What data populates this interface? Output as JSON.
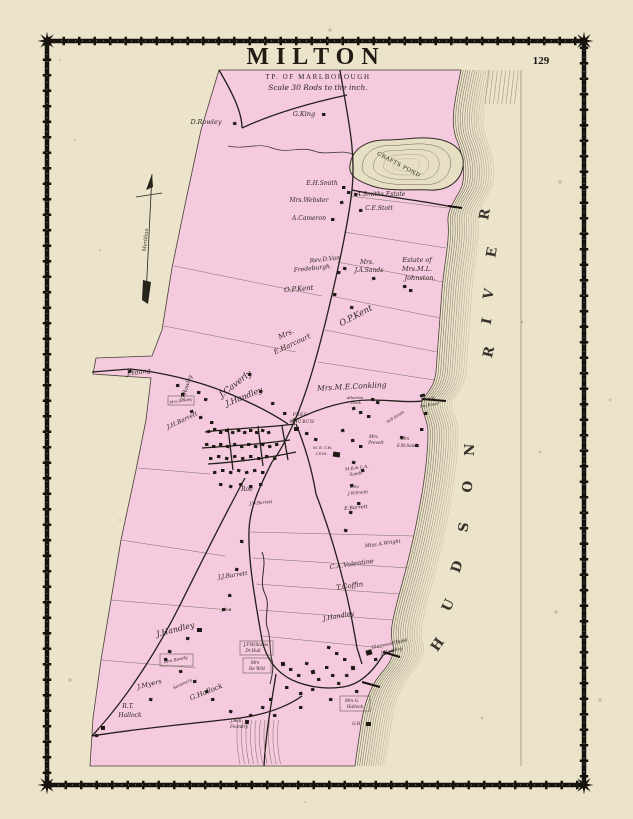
{
  "page": {
    "number": "129"
  },
  "title": {
    "main": "MILTON",
    "township": "TP. OF MARLBOROUGH",
    "scale_note": "Scale 30 Rods to the inch."
  },
  "map": {
    "labels": [
      {
        "t": "D.Rowley",
        "x": 206,
        "y": 124,
        "s": 6.5,
        "r": 0
      },
      {
        "t": "G.King",
        "x": 304,
        "y": 116,
        "s": 6.5,
        "r": 0
      },
      {
        "t": "CRAFTS POND",
        "x": 398,
        "y": 166,
        "s": 5.5,
        "r": 28,
        "c": "c",
        "ls": 1.5
      },
      {
        "t": "E.H.Smith",
        "x": 322,
        "y": 185,
        "s": 6,
        "r": 0
      },
      {
        "t": "A.Smiths Estate",
        "x": 381,
        "y": 196,
        "s": 6,
        "r": 0
      },
      {
        "t": "Mrs.Webster",
        "x": 309,
        "y": 202,
        "s": 6,
        "r": 0
      },
      {
        "t": "C.E.Stott",
        "x": 379,
        "y": 210,
        "s": 6,
        "r": 0
      },
      {
        "t": "A.Cameron",
        "x": 309,
        "y": 220,
        "s": 6,
        "r": 0
      },
      {
        "t": "Rev.D.Van",
        "x": 325,
        "y": 261,
        "s": 6,
        "r": -6
      },
      {
        "t": "Fredeburgh.",
        "x": 313,
        "y": 270,
        "s": 6,
        "r": -6
      },
      {
        "t": "Mrs.",
        "x": 367,
        "y": 264,
        "s": 6,
        "r": 0
      },
      {
        "t": "J.A.Sands",
        "x": 369,
        "y": 272,
        "s": 6,
        "r": 0
      },
      {
        "t": "Estate of",
        "x": 417,
        "y": 262,
        "s": 6.5,
        "r": 0
      },
      {
        "t": "Mrs.M.L.",
        "x": 417,
        "y": 271,
        "s": 6.5,
        "r": 0
      },
      {
        "t": "Johnston.",
        "x": 420,
        "y": 280,
        "s": 6.5,
        "r": 0
      },
      {
        "t": "O.P.Kent",
        "x": 299,
        "y": 291,
        "s": 7,
        "r": -5
      },
      {
        "t": "O.P.Kent",
        "x": 357,
        "y": 318,
        "s": 8.5,
        "r": -28
      },
      {
        "t": "Mrs.",
        "x": 287,
        "y": 336,
        "s": 7,
        "r": -25
      },
      {
        "t": "E.Harcourt",
        "x": 293,
        "y": 346,
        "s": 7,
        "r": -25
      },
      {
        "t": "J.Young",
        "x": 139,
        "y": 374,
        "s": 6.5,
        "r": -8
      },
      {
        "t": "D.Rowley",
        "x": 188,
        "y": 388,
        "s": 5.5,
        "r": -72
      },
      {
        "t": "Mrs.Rowley",
        "x": 181,
        "y": 402,
        "s": 3.8,
        "r": -8
      },
      {
        "t": "J.Caverly",
        "x": 237,
        "y": 386,
        "s": 8.5,
        "r": -38
      },
      {
        "t": "J.Handley",
        "x": 245,
        "y": 399,
        "s": 8,
        "r": -22
      },
      {
        "t": "Mrs.M.E.Conkling",
        "x": 352,
        "y": 389,
        "s": 7.5,
        "r": -3
      },
      {
        "t": "J.H.Barrett",
        "x": 183,
        "y": 422,
        "s": 6,
        "r": -25
      },
      {
        "t": "PRES.",
        "x": 301,
        "y": 416,
        "s": 4.5,
        "r": 0,
        "c": "c"
      },
      {
        "t": "CHURCH",
        "x": 302,
        "y": 423,
        "s": 4.5,
        "r": 0,
        "c": "c"
      },
      {
        "t": "Atherton",
        "x": 355,
        "y": 399,
        "s": 3.8,
        "r": 0
      },
      {
        "t": "Dock",
        "x": 356,
        "y": 404,
        "s": 3.8,
        "r": 0
      },
      {
        "t": "J.Sands",
        "x": 428,
        "y": 400,
        "s": 3.8,
        "r": -10
      },
      {
        "t": "Sto.House",
        "x": 430,
        "y": 406,
        "s": 3.8,
        "r": -10
      },
      {
        "t": "W.B.Sands",
        "x": 396,
        "y": 418,
        "s": 3.8,
        "r": -32
      },
      {
        "t": "Mrs.",
        "x": 374,
        "y": 438,
        "s": 4.2,
        "r": 0
      },
      {
        "t": "Prevett",
        "x": 376,
        "y": 444,
        "s": 4.2,
        "r": 0
      },
      {
        "t": "Mrs",
        "x": 405,
        "y": 440,
        "s": 4.2,
        "r": 0
      },
      {
        "t": "S.M.Sands",
        "x": 408,
        "y": 447,
        "s": 4.2,
        "r": 0
      },
      {
        "t": "M.E.CH.",
        "x": 323,
        "y": 449,
        "s": 3.8,
        "r": 0,
        "c": "c"
      },
      {
        "t": "CEM.",
        "x": 322,
        "y": 455,
        "s": 3.8,
        "r": 0,
        "c": "c"
      },
      {
        "t": "M.B.& L.A.",
        "x": 357,
        "y": 469,
        "s": 4.2,
        "r": -8
      },
      {
        "t": "Sands",
        "x": 356,
        "y": 475,
        "s": 4.2,
        "r": -8
      },
      {
        "t": "Rev.",
        "x": 355,
        "y": 488,
        "s": 4.2,
        "r": 0
      },
      {
        "t": "J.W.Smith",
        "x": 358,
        "y": 494,
        "s": 4.2,
        "r": -5
      },
      {
        "t": "E.Barrett",
        "x": 356,
        "y": 509,
        "s": 5,
        "r": -5
      },
      {
        "t": "Roe",
        "x": 247,
        "y": 491,
        "s": 6,
        "r": 0
      },
      {
        "t": "J.W.Barrett",
        "x": 261,
        "y": 504,
        "s": 4.2,
        "r": -5
      },
      {
        "t": "Miss A.Wright",
        "x": 383,
        "y": 545,
        "s": 5,
        "r": -8
      },
      {
        "t": "C.A.Valentine",
        "x": 352,
        "y": 566,
        "s": 6.5,
        "r": -8
      },
      {
        "t": "T.Coffin",
        "x": 350,
        "y": 588,
        "s": 7,
        "r": -8
      },
      {
        "t": "J.Handley",
        "x": 339,
        "y": 618,
        "s": 6.5,
        "r": -10
      },
      {
        "t": "J.J.Barrett",
        "x": 233,
        "y": 577,
        "s": 6,
        "r": -8
      },
      {
        "t": "J.C.B.",
        "x": 227,
        "y": 611,
        "s": 4,
        "r": 0
      },
      {
        "t": "J.Handley",
        "x": 176,
        "y": 632,
        "s": 8,
        "r": -14
      },
      {
        "t": "Mrs.Bowdy",
        "x": 176,
        "y": 661,
        "s": 4.2,
        "r": -12
      },
      {
        "t": "J.Myers",
        "x": 150,
        "y": 686,
        "s": 6.5,
        "r": -14
      },
      {
        "t": "Seminary",
        "x": 183,
        "y": 685,
        "s": 4.2,
        "r": -26
      },
      {
        "t": "G.Hallock",
        "x": 207,
        "y": 694,
        "s": 7,
        "r": -22
      },
      {
        "t": "R.T.",
        "x": 128,
        "y": 708,
        "s": 6,
        "r": 0
      },
      {
        "t": "Hallock",
        "x": 130,
        "y": 717,
        "s": 6,
        "r": 0
      },
      {
        "t": "J.F.Williams",
        "x": 256,
        "y": 646,
        "s": 4.2,
        "r": 0
      },
      {
        "t": "Dr.Hull",
        "x": 253,
        "y": 652,
        "s": 4.2,
        "r": 0
      },
      {
        "t": "Mrs",
        "x": 255,
        "y": 664,
        "s": 4.2,
        "r": 0
      },
      {
        "t": "De Witt",
        "x": 257,
        "y": 670,
        "s": 4.2,
        "r": 0
      },
      {
        "t": "Mrs G.",
        "x": 352,
        "y": 702,
        "s": 4.2,
        "r": 0
      },
      {
        "t": "Hallock",
        "x": 355,
        "y": 708,
        "s": 4.2,
        "r": 0
      },
      {
        "t": "G.H.",
        "x": 357,
        "y": 725,
        "s": 4.2,
        "r": 0
      },
      {
        "t": "J.Bell",
        "x": 236,
        "y": 722,
        "s": 4.2,
        "r": 0
      },
      {
        "t": "Foundry",
        "x": 239,
        "y": 728,
        "s": 4.2,
        "r": 0
      },
      {
        "t": "Glenwood Hotel",
        "x": 390,
        "y": 645,
        "s": 4.5,
        "r": -12
      },
      {
        "t": "J.Handley",
        "x": 392,
        "y": 652,
        "s": 4.5,
        "r": -12
      },
      {
        "t": "Meridian",
        "x": 147,
        "y": 240,
        "s": 5,
        "r": -84
      }
    ],
    "river_letters": [
      {
        "ch": "R",
        "x": 489,
        "y": 215,
        "r": -80
      },
      {
        "ch": "E",
        "x": 496,
        "y": 253,
        "r": -80
      },
      {
        "ch": "V",
        "x": 493,
        "y": 295,
        "r": -78
      },
      {
        "ch": "I",
        "x": 491,
        "y": 322,
        "r": -78
      },
      {
        "ch": "R",
        "x": 493,
        "y": 353,
        "r": -76
      },
      {
        "ch": "N",
        "x": 474,
        "y": 450,
        "r": -88
      },
      {
        "ch": "O",
        "x": 472,
        "y": 487,
        "r": -86
      },
      {
        "ch": "S",
        "x": 468,
        "y": 528,
        "r": -80
      },
      {
        "ch": "D",
        "x": 461,
        "y": 568,
        "r": -72
      },
      {
        "ch": "U",
        "x": 452,
        "y": 607,
        "r": -65
      },
      {
        "ch": "H",
        "x": 441,
        "y": 647,
        "r": -55
      }
    ]
  }
}
